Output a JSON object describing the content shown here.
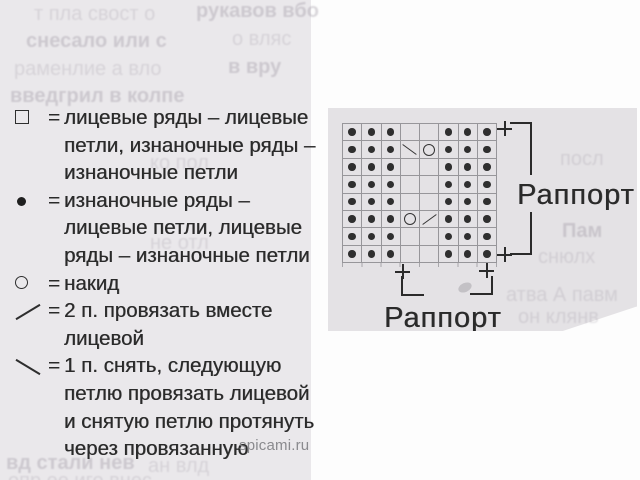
{
  "colors": {
    "page_bg": "#fdfdfd",
    "left_column_bg": "#eae8eb",
    "panel_bg": "#e4e2e5",
    "ink": "#2a2a2a",
    "grid_line": "#97969a",
    "watermark_color": "#8a8a8e"
  },
  "legend": {
    "equals": "=",
    "items": [
      {
        "symbol": "empty-square-icon",
        "lines": [
          "лицевые ряды – лицевые",
          "петли, изнаночные ряды –",
          "изнаночные петли"
        ]
      },
      {
        "symbol": "filled-dot-icon",
        "lines": [
          "изнаночные ряды –",
          "лицевые петли, лицевые",
          "ряды – изнаночные петли"
        ]
      },
      {
        "symbol": "circle-icon",
        "lines": [
          "накид"
        ]
      },
      {
        "symbol": "slash-icon",
        "lines": [
          "2 п. провязать вместе",
          "лицевой"
        ]
      },
      {
        "symbol": "backslash-icon",
        "lines": [
          "1 п. снять, следующую",
          "петлю провязать лицевой",
          "и снятую петлю протянуть",
          "через провязанную"
        ]
      }
    ]
  },
  "watermark": "spicami.ru",
  "chart": {
    "labels": {
      "right": "Раппорт",
      "bottom": "Раппорт"
    },
    "plus_sign": "+"
  },
  "chart_data": {
    "type": "heatmap",
    "title": "knitting pattern chart 8x8",
    "rows": 8,
    "cols": 8,
    "grid": [
      [
        "d",
        "d",
        "d",
        "",
        "",
        "d",
        "d",
        "d"
      ],
      [
        "d",
        "d",
        "d",
        "\\",
        "o",
        "d",
        "d",
        "d"
      ],
      [
        "d",
        "d",
        "d",
        "",
        "",
        "d",
        "d",
        "d"
      ],
      [
        "d",
        "d",
        "d",
        "",
        "",
        "d",
        "d",
        "d"
      ],
      [
        "d",
        "d",
        "d",
        "",
        "",
        "d",
        "d",
        "d"
      ],
      [
        "d",
        "d",
        "d",
        "o",
        "/",
        "d",
        "d",
        "d"
      ],
      [
        "d",
        "d",
        "d",
        "",
        "",
        "d",
        "d",
        "d"
      ],
      [
        "d",
        "d",
        "d",
        "",
        "",
        "d",
        "d",
        "d"
      ]
    ],
    "symbols": {
      "d": "purl-dot",
      "o": "yarn-over",
      "/": "knit-2-together",
      "\\": "slip-1-knit-1-psso",
      "": "blank-knit"
    },
    "legend_position": "left",
    "repeat_label": "Раппорт"
  },
  "bleed_fragments": [
    {
      "x": 34,
      "y": 3,
      "t": "т пла свост о"
    },
    {
      "x": 196,
      "y": 0,
      "t": "рукавов вбо",
      "b": 1
    },
    {
      "x": 26,
      "y": 30,
      "t": "снесало или с",
      "b": 1
    },
    {
      "x": 232,
      "y": 28,
      "t": "о вляс"
    },
    {
      "x": 14,
      "y": 58,
      "t": "раменлие а вло"
    },
    {
      "x": 228,
      "y": 56,
      "t": "в вру",
      "b": 1
    },
    {
      "x": 10,
      "y": 85,
      "t": "введгрил в колпе",
      "b": 1
    },
    {
      "x": 150,
      "y": 152,
      "t": "ко пол"
    },
    {
      "x": 150,
      "y": 232,
      "t": "не отл"
    },
    {
      "x": 6,
      "y": 452,
      "t": "вд стали нев",
      "b": 1
    },
    {
      "x": 148,
      "y": 455,
      "t": "ан влд"
    },
    {
      "x": 8,
      "y": 470,
      "t": "опр ее иго внес"
    },
    {
      "x": 560,
      "y": 148,
      "t": "посл"
    },
    {
      "x": 562,
      "y": 220,
      "t": "Пам",
      "b": 1
    },
    {
      "x": 538,
      "y": 246,
      "t": "снюлх"
    },
    {
      "x": 506,
      "y": 284,
      "t": "атва А павм"
    },
    {
      "x": 518,
      "y": 306,
      "t": "он клянв"
    }
  ]
}
